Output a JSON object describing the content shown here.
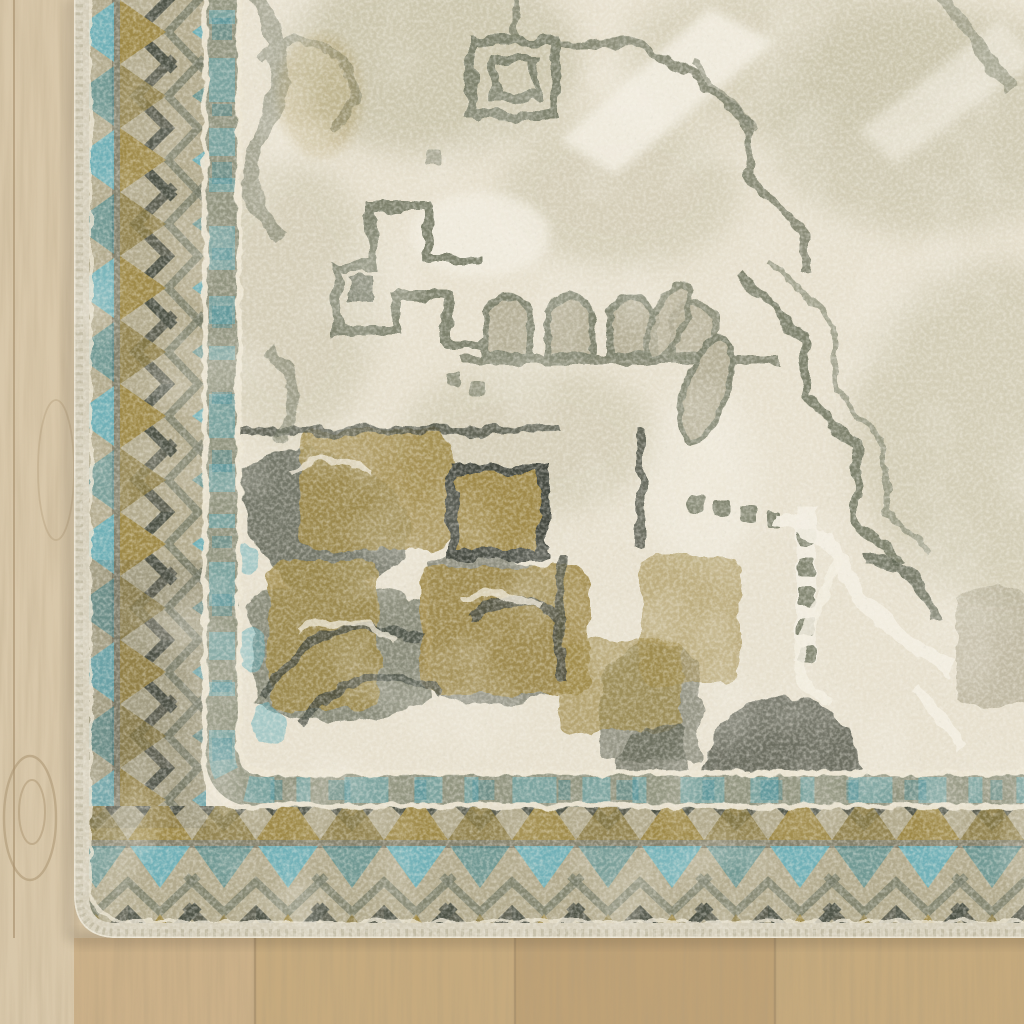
{
  "scene": {
    "description": "Corner detail of a distressed vintage medallion-style area rug in ivory, beige, grey, gold and teal, lying on a light oak wood floor",
    "subject": "area rug corner on wood floor",
    "rug": {
      "style": "vintage distressed oriental medallion",
      "field_motifs": [
        "stepped medallion outline",
        "arch row",
        "fret hook",
        "dotted square chains",
        "corner spandrel with gold patches",
        "scroll with cream outline"
      ],
      "border_motifs": [
        "chevron zigzag band with teal triangles",
        "gold triangles",
        "white pinstripes",
        "grey accent band",
        "pale serged binding edge"
      ]
    },
    "floor": {
      "material": "light oak laminate planks",
      "grain": "vertical"
    }
  },
  "palette": {
    "wood_base": "#d2bf9f",
    "wood_left": "#d9c8aa",
    "wood_plank_a": "#ccb189",
    "wood_plank_b": "#c7ab7e",
    "wood_plank_c": "#bfa276",
    "wood_plank_d": "#c6aa7d",
    "wood_seam": "#a68e6a",
    "shadow": "#3a3125",
    "serge": "#d5ceba",
    "serge_stitch": "#b4ad94",
    "edge_highlight": "#f0ead9",
    "border_bg": "#b2aa8d",
    "border_dark": "#4c5145",
    "border_mid": "#6e7361",
    "gold": "#9e8947",
    "gold_dark": "#8b7b41",
    "gold_patch": "#a08a48",
    "teal": "#64b2bf",
    "teal_dark": "#3c8a99",
    "band_grey": "#8d907b",
    "pinstripe": "#ece5d2",
    "field": "#e8e1cf",
    "field_light": "#f3eee1",
    "field_beige": "#c5bfa4",
    "field_beige_dark": "#b1ab90",
    "motif_grey": "#7d816c",
    "motif_grey_dark": "#5c6153",
    "motif_fill": "#b6b098",
    "motif_dark": "#454a40"
  }
}
